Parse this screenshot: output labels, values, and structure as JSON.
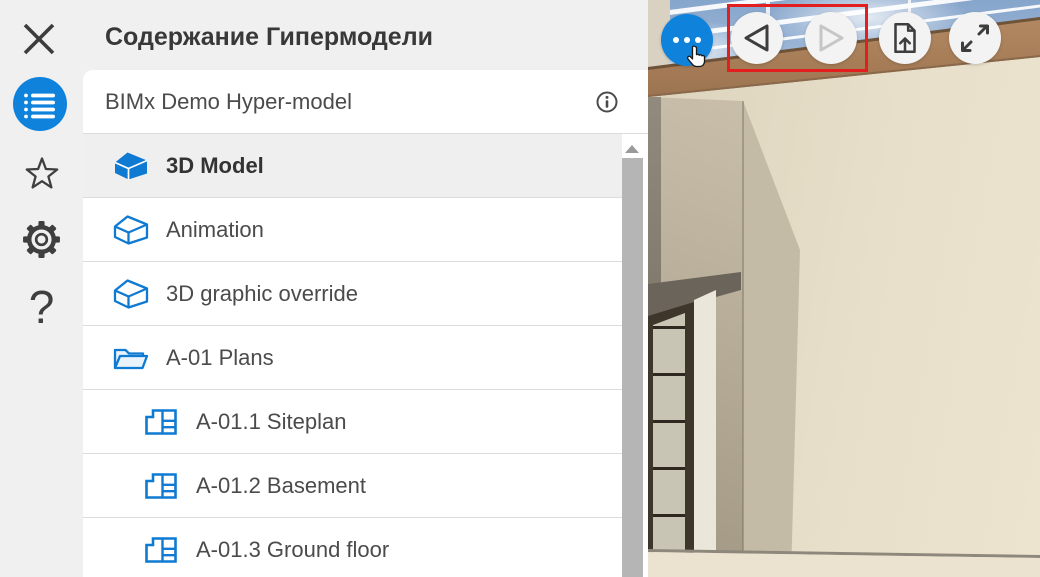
{
  "header": {
    "title": "Содержание Гипермодели"
  },
  "rail": {
    "items": [
      {
        "name": "contents",
        "icon": "list-icon",
        "active": true
      },
      {
        "name": "favorites",
        "icon": "star-icon",
        "active": false
      },
      {
        "name": "settings",
        "icon": "gear-icon",
        "active": false
      },
      {
        "name": "help",
        "icon": "question-mark-icon",
        "glyph": "?",
        "active": false
      }
    ]
  },
  "model_header": {
    "name": "BIMx Demo Hyper-model",
    "info_icon": "info-icon"
  },
  "list": {
    "items": [
      {
        "label": "3D Model",
        "icon": "house-filled",
        "selected": true,
        "indent": 0
      },
      {
        "label": "Animation",
        "icon": "house-outline",
        "selected": false,
        "indent": 0
      },
      {
        "label": "3D graphic override",
        "icon": "house-outline",
        "selected": false,
        "indent": 0
      },
      {
        "label": "A-01 Plans",
        "icon": "folder",
        "selected": false,
        "indent": 0
      },
      {
        "label": "A-01.1 Siteplan",
        "icon": "layout",
        "selected": false,
        "indent": 1
      },
      {
        "label": "A-01.2 Basement",
        "icon": "layout",
        "selected": false,
        "indent": 1
      },
      {
        "label": "A-01.3 Ground floor",
        "icon": "layout",
        "selected": false,
        "indent": 1
      }
    ]
  },
  "toolbar": {
    "buttons": [
      {
        "name": "more",
        "icon": "ellipsis-icon",
        "style": "primary",
        "enabled": true
      },
      {
        "name": "previous",
        "icon": "triangle-left-icon",
        "enabled": true,
        "highlighted": true
      },
      {
        "name": "next",
        "icon": "triangle-right-icon",
        "enabled": false,
        "highlighted": true
      },
      {
        "name": "export",
        "icon": "document-upload-icon",
        "enabled": true
      },
      {
        "name": "fullscreen",
        "icon": "expand-arrows-icon",
        "enabled": true
      }
    ],
    "highlight_color": "#e31e1e"
  },
  "scene": {
    "type": "3d-model-view",
    "content": "building exterior corner with pergola, sky and door"
  },
  "overlay": {
    "cursor": "pointer-hand"
  },
  "colors": {
    "accent_blue": "#0f82dc",
    "icon_blue": "#0f7ad2",
    "selected_row_bg": "#efefef",
    "panel_bg": "#f0f0f0",
    "divider": "#dcdcdc",
    "highlight_red": "#e31e1e"
  }
}
